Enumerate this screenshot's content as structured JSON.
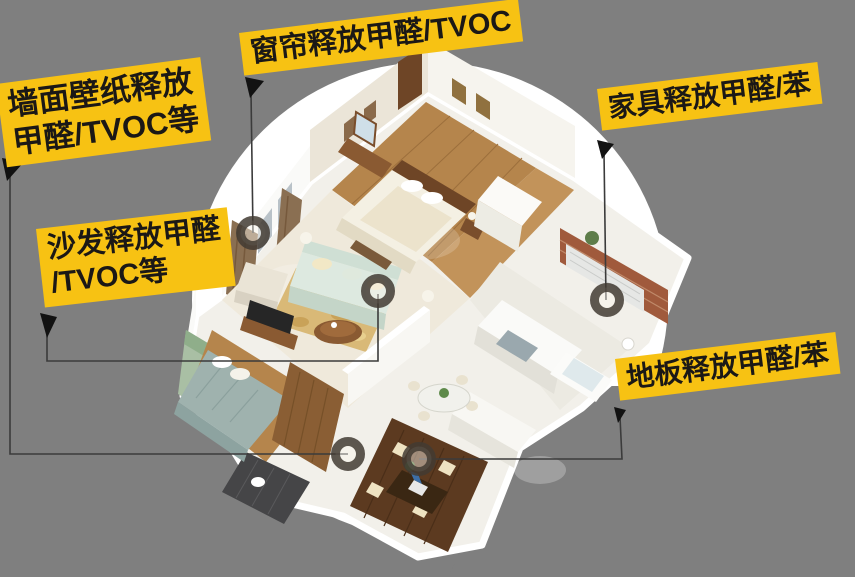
{
  "colors": {
    "background": "#7F7F7F",
    "spotlight": "#FFFFFF",
    "label_bg": "#F7C213",
    "label_text": "#1B1816",
    "connector": "#3B3B3B",
    "marker_ring": "#423B33"
  },
  "labels": {
    "wallpaper": {
      "line1": "墙面壁纸释放",
      "line2": "甲醛/TVOC等"
    },
    "curtain": {
      "line1": "窗帘释放甲醛/TVOC",
      "line2": ""
    },
    "sofa": {
      "line1": "沙发释放甲醛",
      "line2": "/TVOC等"
    },
    "furniture": {
      "line1": "家具释放甲醛/苯",
      "line2": ""
    },
    "floor": {
      "line1": "地板释放甲醛/苯",
      "line2": ""
    }
  },
  "markers": [
    "curtain-emission-point",
    "sofa-emission-point",
    "furniture-emission-point",
    "wall-emission-point",
    "floor-emission-point"
  ]
}
